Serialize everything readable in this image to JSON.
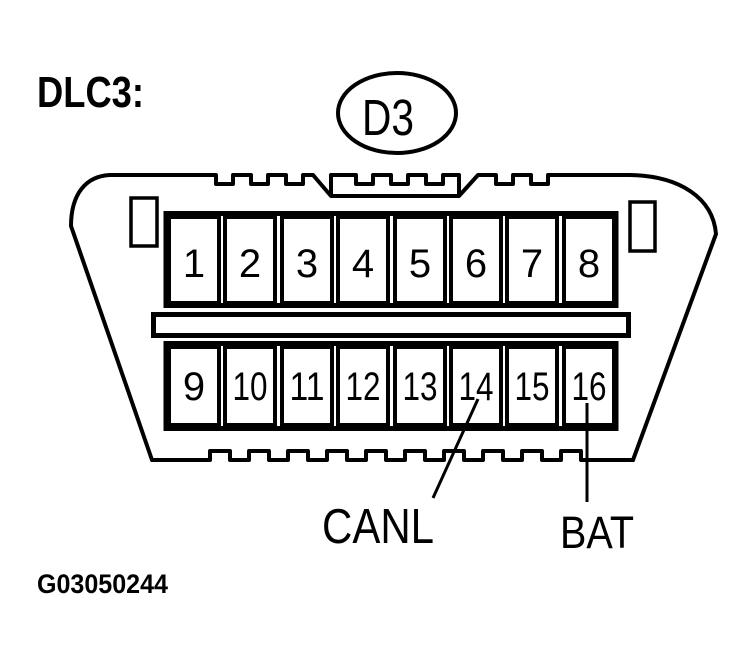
{
  "figure": {
    "heading": "DLC3:",
    "connector_code": "D3",
    "figure_id": "G03050244"
  },
  "pins": {
    "top_row": [
      "1",
      "2",
      "3",
      "4",
      "5",
      "6",
      "7",
      "8"
    ],
    "bottom_row": [
      "9",
      "10",
      "11",
      "12",
      "13",
      "14",
      "15",
      "16"
    ]
  },
  "callouts": [
    {
      "pin": "14",
      "label": "CANL"
    },
    {
      "pin": "16",
      "label": "BAT"
    }
  ],
  "colors": {
    "ink": "#000000",
    "paper": "#ffffff"
  }
}
